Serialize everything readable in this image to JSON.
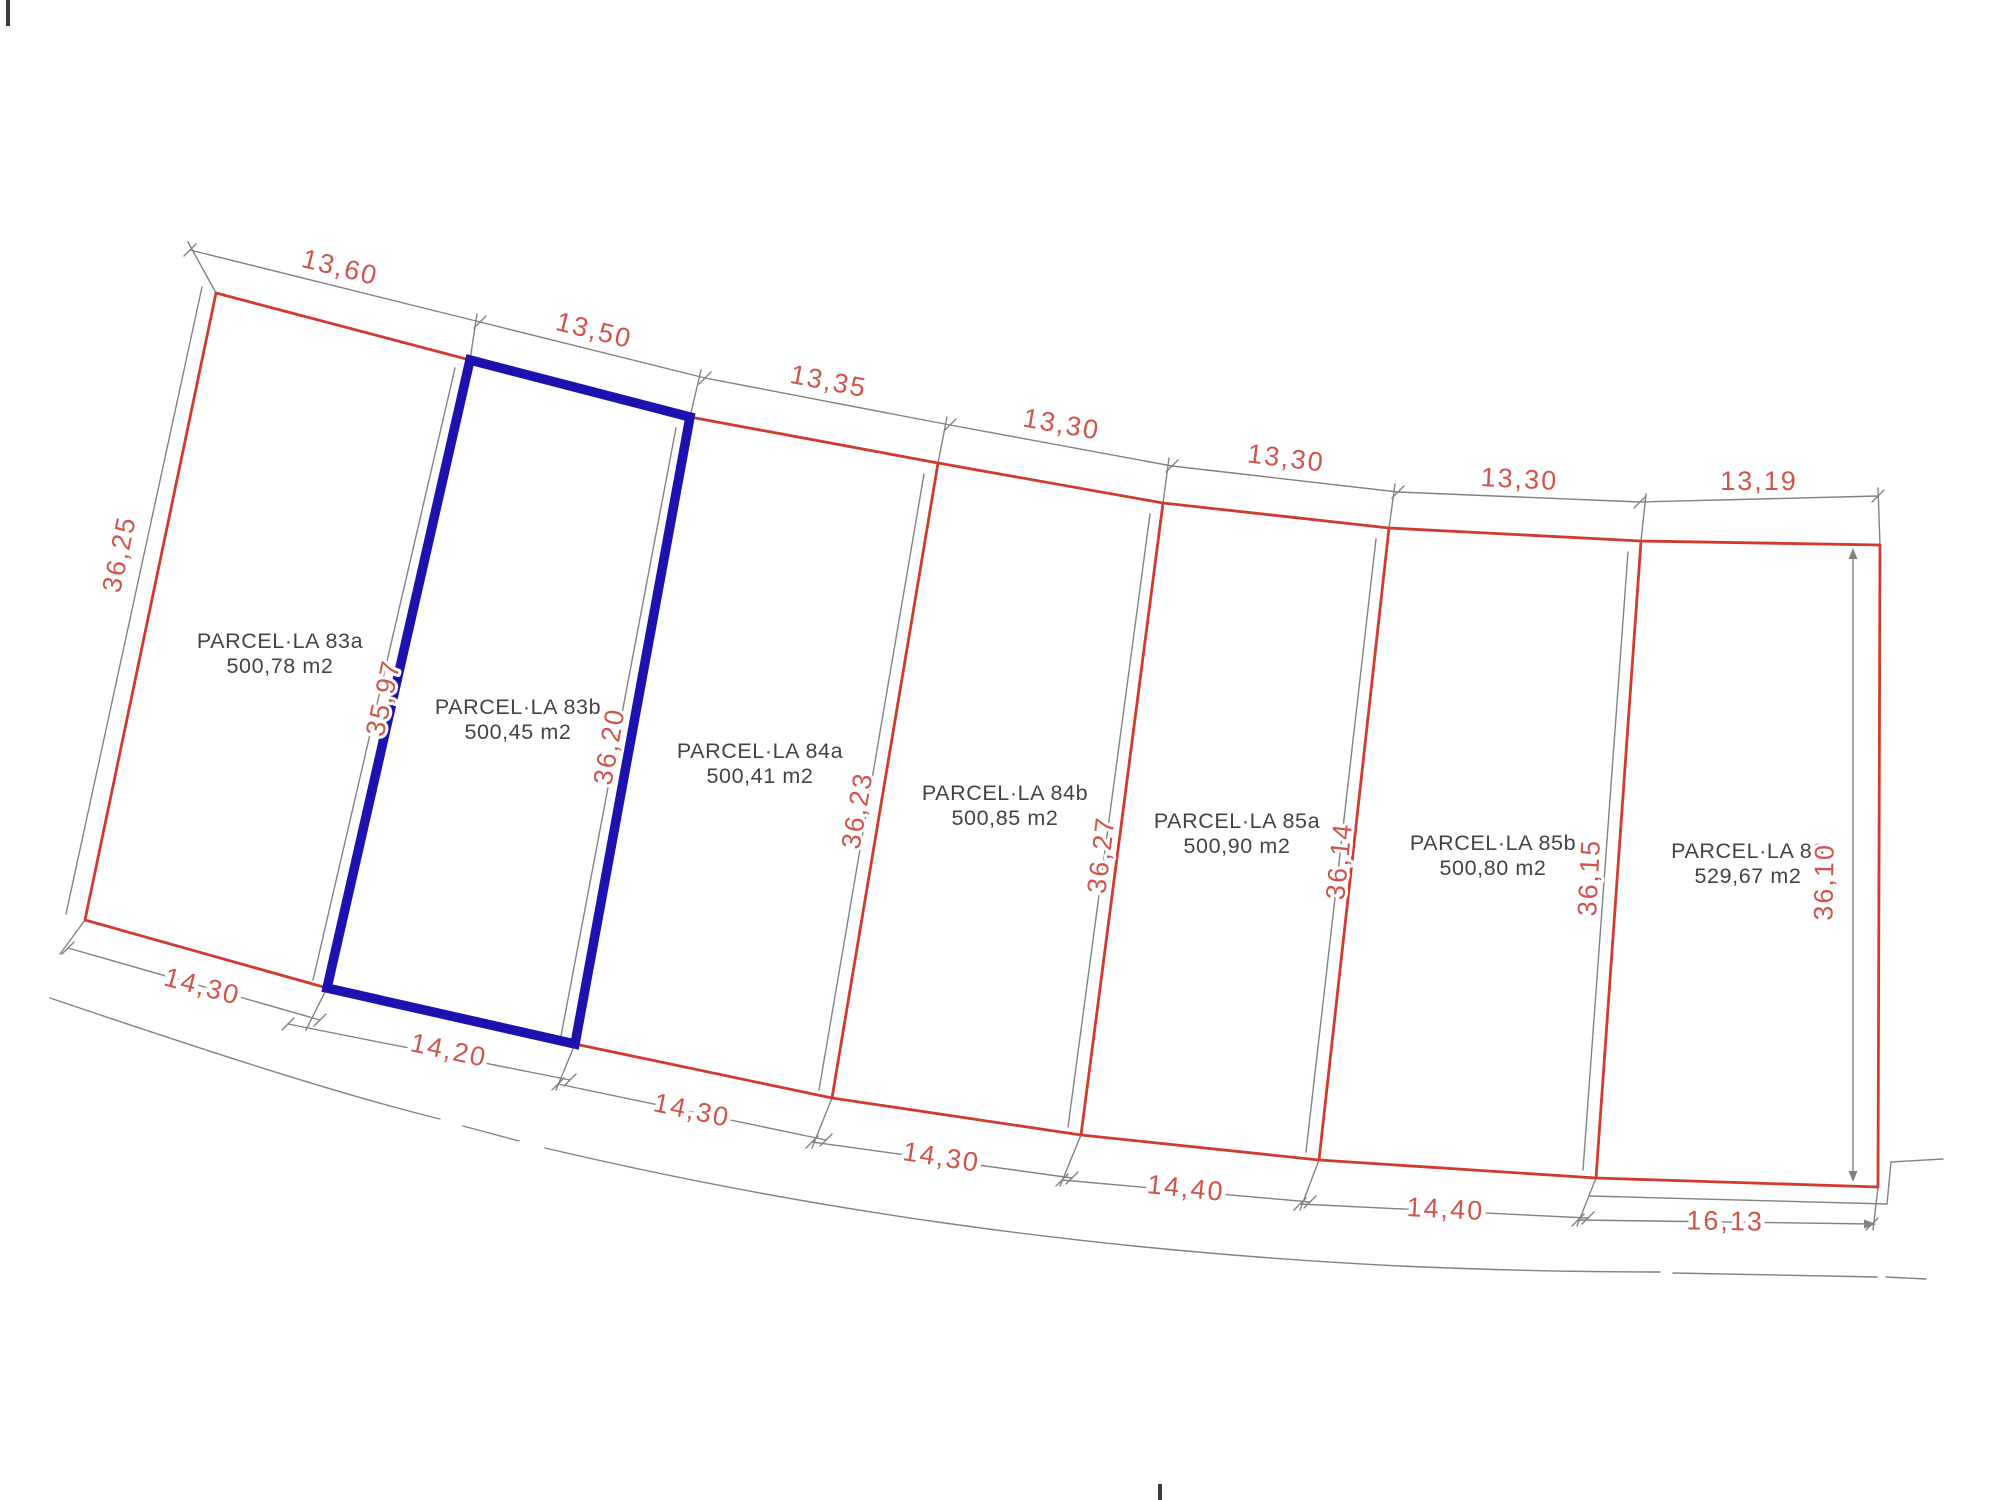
{
  "parcels": [
    {
      "id": "83a",
      "name": "PARCEL·LA 83a",
      "area": "500,78 m2",
      "highlighted": false
    },
    {
      "id": "83b",
      "name": "PARCEL·LA 83b",
      "area": "500,45 m2",
      "highlighted": true
    },
    {
      "id": "84a",
      "name": "PARCEL·LA 84a",
      "area": "500,41 m2",
      "highlighted": false
    },
    {
      "id": "84b",
      "name": "PARCEL·LA 84b",
      "area": "500,85 m2",
      "highlighted": false
    },
    {
      "id": "85a",
      "name": "PARCEL·LA 85a",
      "area": "500,90 m2",
      "highlighted": false
    },
    {
      "id": "85b",
      "name": "PARCEL·LA 85b",
      "area": "500,80 m2",
      "highlighted": false
    },
    {
      "id": "86",
      "name": "PARCEL·LA 86",
      "area": "529,67 m2",
      "highlighted": false
    }
  ],
  "dimensions": {
    "top": [
      "13,60",
      "13,50",
      "13,35",
      "13,30",
      "13,30",
      "13,30",
      "13,19"
    ],
    "bottom": [
      "14,30",
      "14,20",
      "14,30",
      "14,30",
      "14,40",
      "14,40",
      "16,13"
    ],
    "sides": [
      "36,25",
      "35,97",
      "36,20",
      "36,23",
      "36,27",
      "36,14",
      "36,15",
      "36,10"
    ]
  },
  "colors": {
    "boundary": "#d03a2f",
    "highlight": "#1d12b0",
    "construction": "#828282",
    "dimension_text": "#d0544b",
    "label_text": "#434343"
  }
}
